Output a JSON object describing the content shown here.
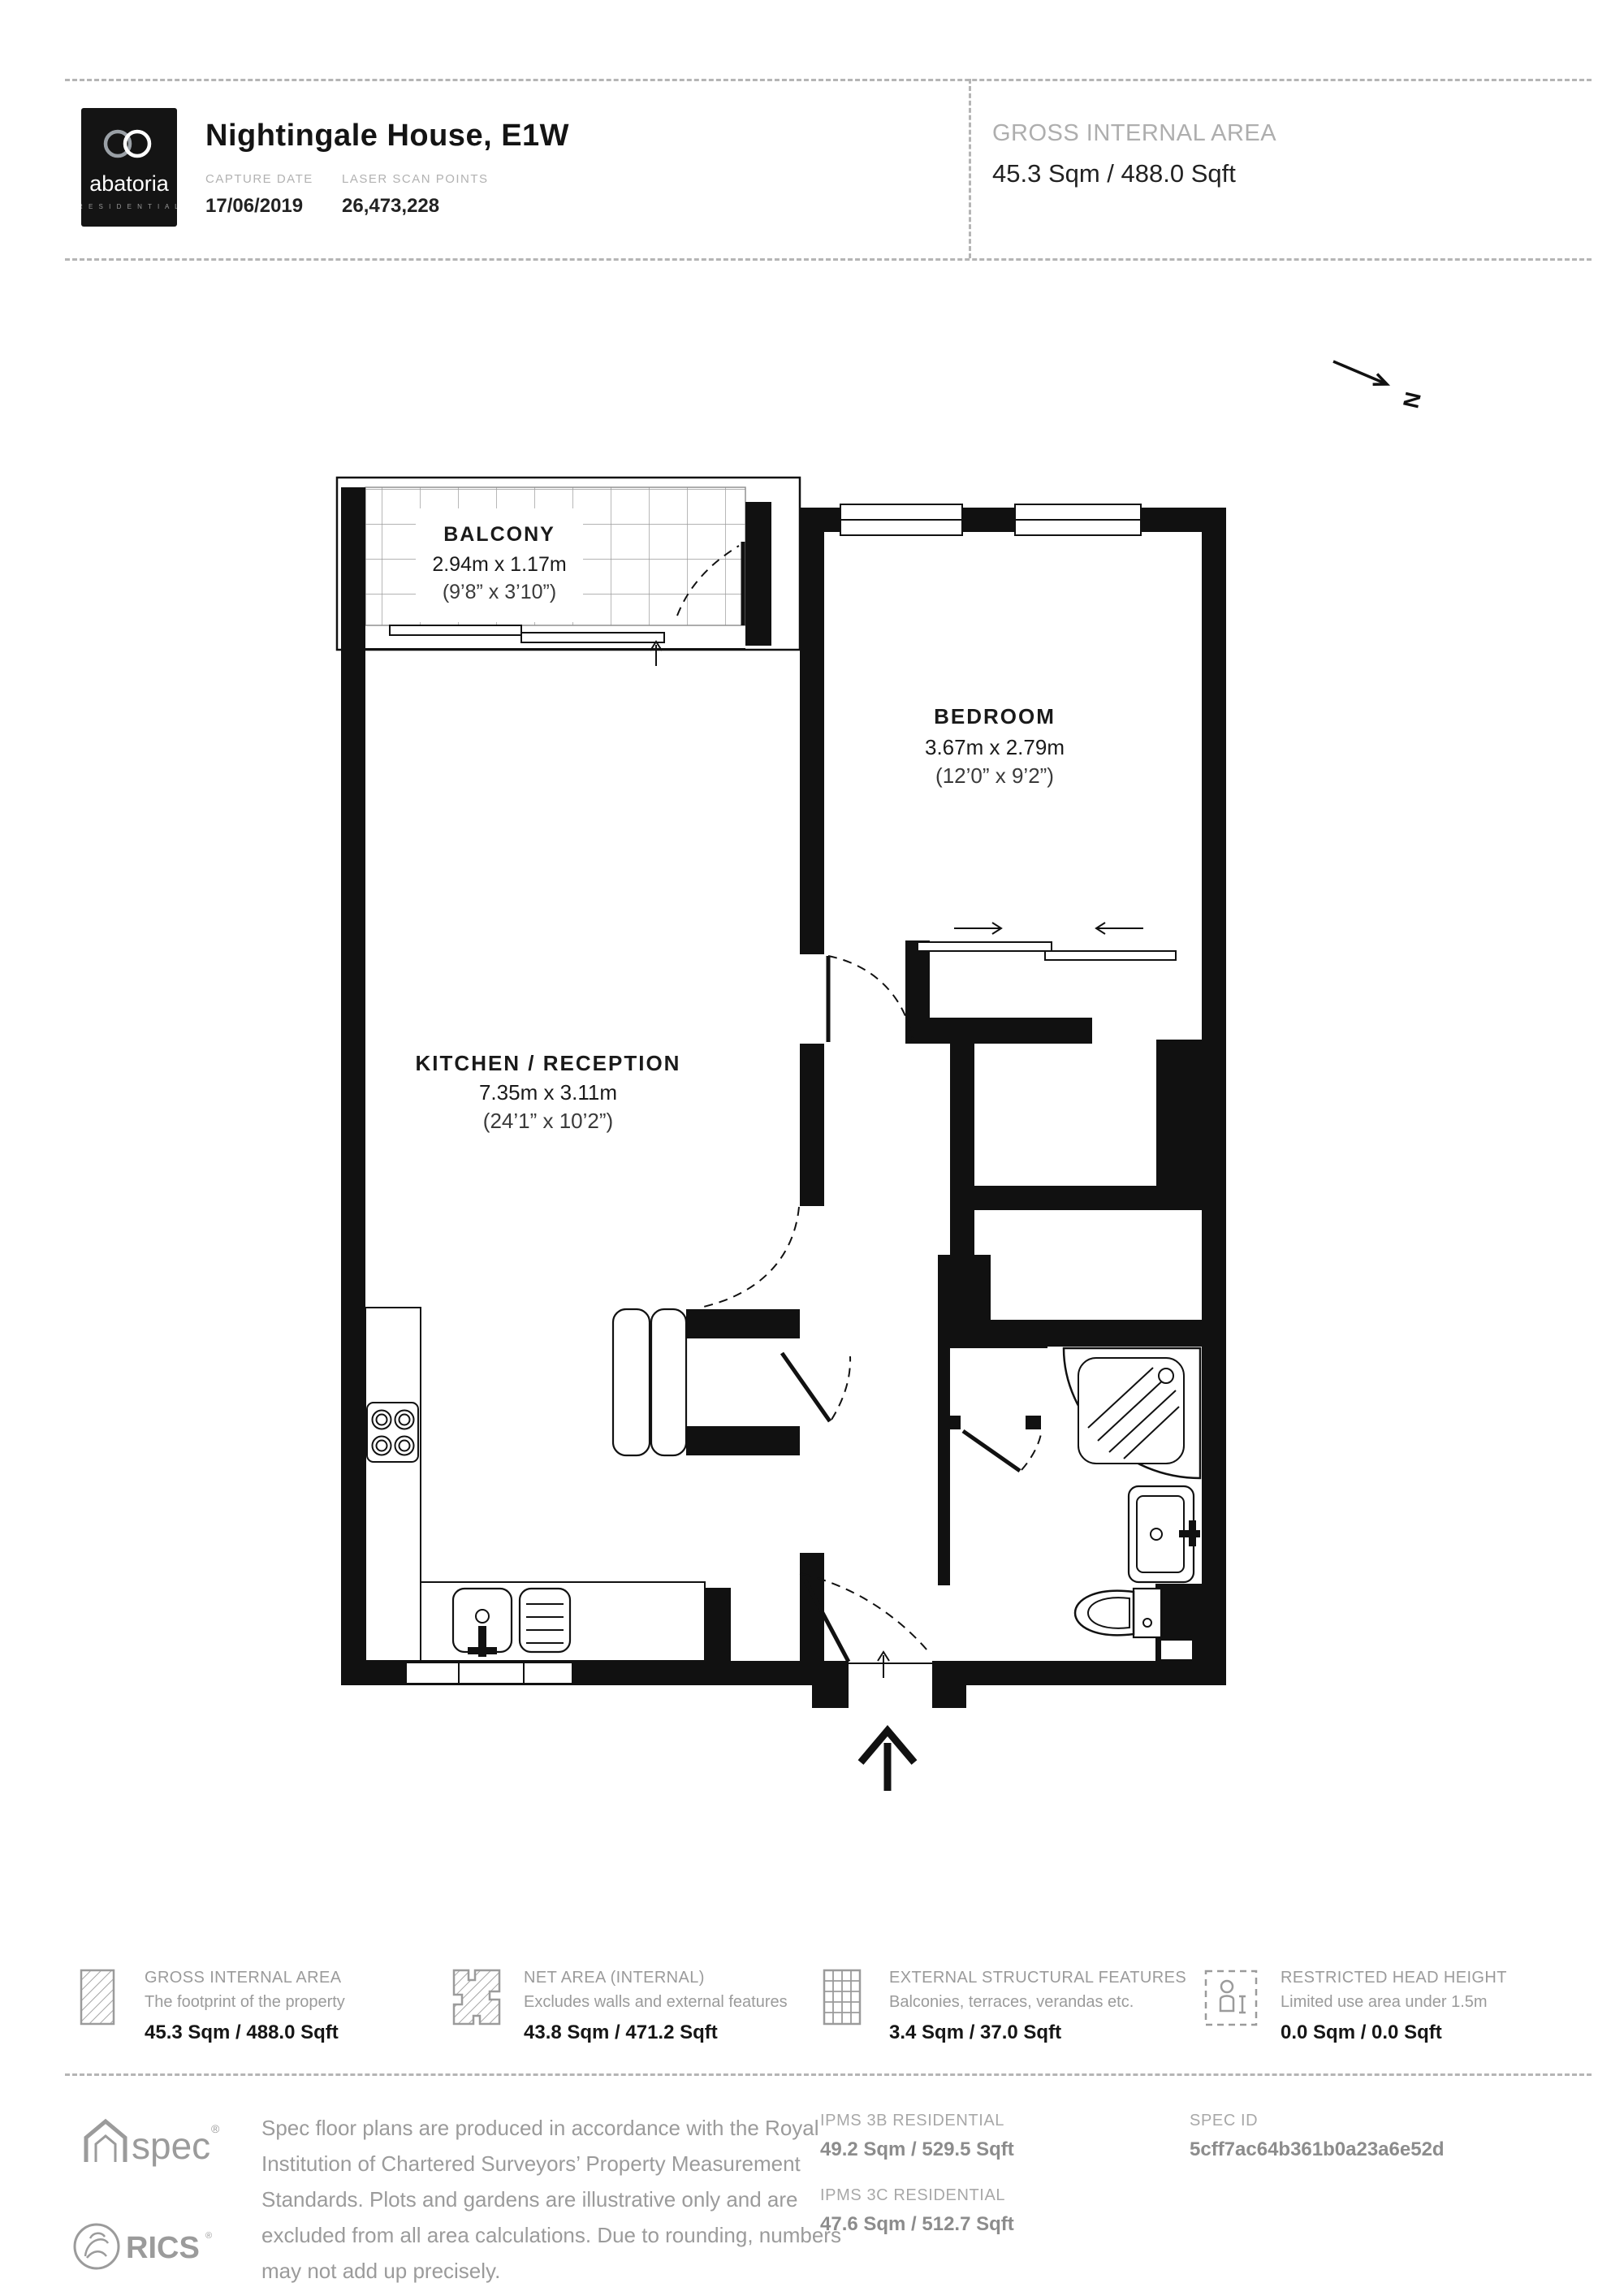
{
  "header": {
    "brand": "abatoria",
    "brand_sub": "R E S I D E N T I A L",
    "title": "Nightingale House, E1W",
    "capture_date_label": "CAPTURE DATE",
    "capture_date": "17/06/2019",
    "laser_label": "LASER SCAN POINTS",
    "laser_points": "26,473,228",
    "gia_label": "GROSS INTERNAL AREA",
    "gia_value": "45.3 Sqm / 488.0 Sqft"
  },
  "plan": {
    "north": "N",
    "floor_label": "— Third Floor",
    "balcony": {
      "name": "BALCONY",
      "metric": "2.94m x 1.17m",
      "imperial": "(9’8” x 3’10”)"
    },
    "bedroom": {
      "name": "BEDROOM",
      "metric": "3.67m x 2.79m",
      "imperial": "(12’0” x 9’2”)"
    },
    "kitchen": {
      "name": "KITCHEN / RECEPTION",
      "metric": "7.35m x 3.11m",
      "imperial": "(24’1” x 10’2”)"
    }
  },
  "legend": {
    "items": [
      {
        "title": "GROSS INTERNAL AREA",
        "subtitle": "The footprint of the property",
        "value": "45.3 Sqm / 488.0 Sqft",
        "icon": "hatched-rect-icon"
      },
      {
        "title": "NET AREA (INTERNAL)",
        "subtitle": "Excludes walls and external features",
        "value": "43.8 Sqm / 471.2 Sqft",
        "icon": "hatched-plan-icon"
      },
      {
        "title": "EXTERNAL STRUCTURAL FEATURES",
        "subtitle": "Balconies, terraces, verandas etc.",
        "value": "3.4 Sqm / 37.0 Sqft",
        "icon": "grid-rect-icon"
      },
      {
        "title": "RESTRICTED HEAD HEIGHT",
        "subtitle": "Limited use area under 1.5m",
        "value": "0.0 Sqm / 0.0 Sqft",
        "icon": "person-height-icon"
      }
    ]
  },
  "footer": {
    "spec_logo": "spec",
    "rics_logo": "RICS",
    "disclaimer": "Spec floor plans are produced in accordance with the Royal Institution of Chartered Surveyors’ Property Measurement Standards. Plots and gardens are illustrative only and are excluded from all area calculations. Due to rounding, numbers may not add up precisely.",
    "ipms3b_label": "IPMS 3B RESIDENTIAL",
    "ipms3b_value": "49.2 Sqm / 529.5 Sqft",
    "ipms3c_label": "IPMS 3C RESIDENTIAL",
    "ipms3c_value": "47.6 Sqm / 512.7 Sqft",
    "spec_id_label": "SPEC ID",
    "spec_id_value": "5cff7ac64b361b0a23a6e52d"
  }
}
